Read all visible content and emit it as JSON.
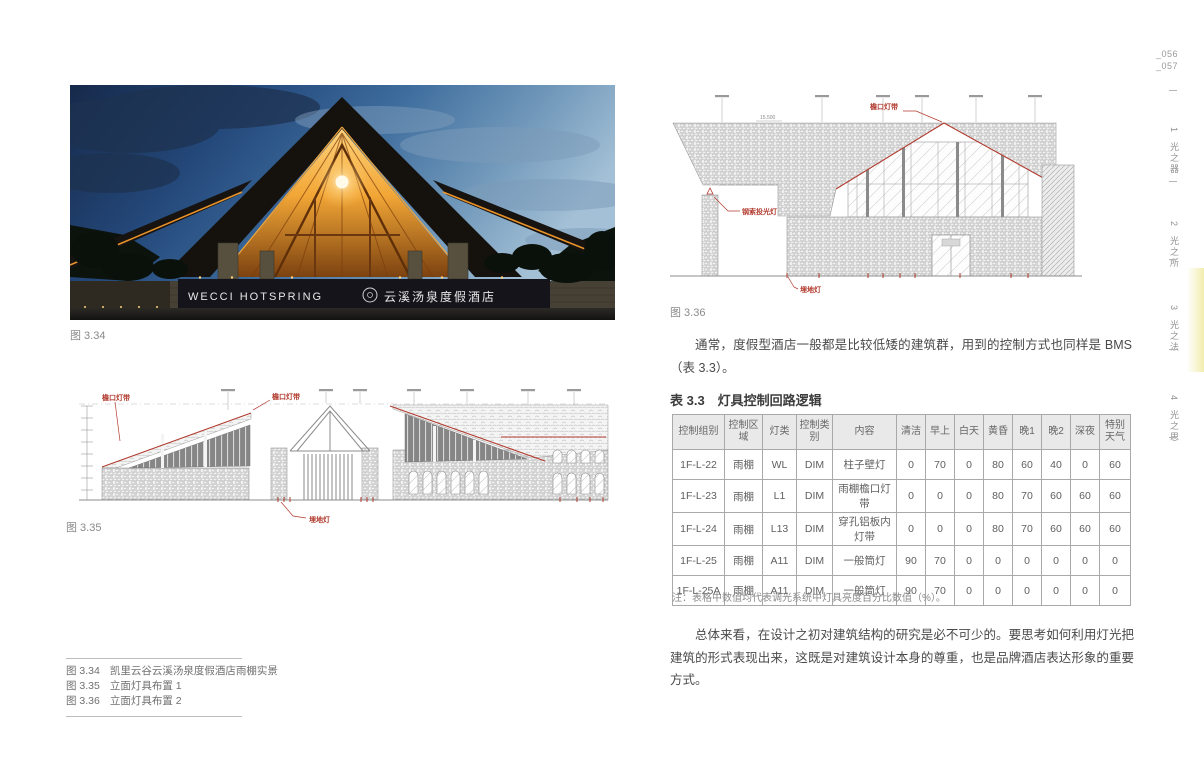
{
  "page": {
    "numbers": [
      "_056",
      "_057"
    ]
  },
  "sidebar_tabs": {
    "items": [
      {
        "num": "1",
        "label": "光之器"
      },
      {
        "num": "2",
        "label": "光之所"
      },
      {
        "num": "3",
        "label": "光之法"
      },
      {
        "num": "4",
        "label": "光之思"
      }
    ],
    "highlight_color": "#f1edae"
  },
  "photo": {
    "caption": "图 3.34",
    "sign_en": "WECCI HOTSPRING",
    "sign_cn": "云溪汤泉度假酒店"
  },
  "figure35": {
    "caption": "图 3.35",
    "label_eave_left": "檐口灯带",
    "label_eave_center": "檐口灯带",
    "label_ground": "埋地灯"
  },
  "figure36": {
    "caption": "图 3.36",
    "label_eave": "檐口灯带",
    "label_flood": "钢索投光灯",
    "label_ground": "埋地灯",
    "dim": "15.500"
  },
  "text": {
    "paragraph1": "通常，度假型酒店一般都是比较低矮的建筑群，用到的控制方式也同样是 BMS（表 3.3）。",
    "paragraph2": "总体来看，在设计之初对建筑结构的研究是必不可少的。要思考如何利用灯光把建筑的形式表现出来，这既是对建筑设计本身的尊重，也是品牌酒店表达形象的重要方式。"
  },
  "table": {
    "title": "表 3.3　灯具控制回路逻辑",
    "headers": [
      "控制组别",
      "控制区域",
      "灯类",
      "控制类别",
      "内容",
      "清洁",
      "早上",
      "白天",
      "黄昏",
      "晚1",
      "晚2",
      "深夜",
      "特别天气"
    ],
    "rows": [
      [
        "1F-L-22",
        "雨棚",
        "WL",
        "DIM",
        "柱子壁灯",
        "0",
        "70",
        "0",
        "80",
        "60",
        "40",
        "0",
        "60"
      ],
      [
        "1F-L-23",
        "雨棚",
        "L1",
        "DIM",
        "雨棚檐口灯带",
        "0",
        "0",
        "0",
        "80",
        "70",
        "60",
        "60",
        "60"
      ],
      [
        "1F-L-24",
        "雨棚",
        "L13",
        "DIM",
        "穿孔铝板内灯带",
        "0",
        "0",
        "0",
        "80",
        "70",
        "60",
        "60",
        "60"
      ],
      [
        "1F-L-25",
        "雨棚",
        "A11",
        "DIM",
        "一般筒灯",
        "90",
        "70",
        "0",
        "0",
        "0",
        "0",
        "0",
        "0"
      ],
      [
        "1F-L-25A",
        "雨棚",
        "A11",
        "DIM",
        "一般筒灯",
        "90",
        "70",
        "0",
        "0",
        "0",
        "0",
        "0",
        "0"
      ]
    ],
    "note": "注：表格中数值均代表调光系统中灯具亮度百分比数值（%）。"
  },
  "caption_list": [
    {
      "fig": "图 3.34",
      "text": "凯里云谷云溪汤泉度假酒店雨棚实景"
    },
    {
      "fig": "图 3.35",
      "text": "立面灯具布置 1"
    },
    {
      "fig": "图 3.36",
      "text": "立面灯具布置 2"
    }
  ],
  "colors": {
    "accent_red": "#b23b2e",
    "table_border": "#a9a9a9",
    "header_bg": "#e9e9e9"
  }
}
